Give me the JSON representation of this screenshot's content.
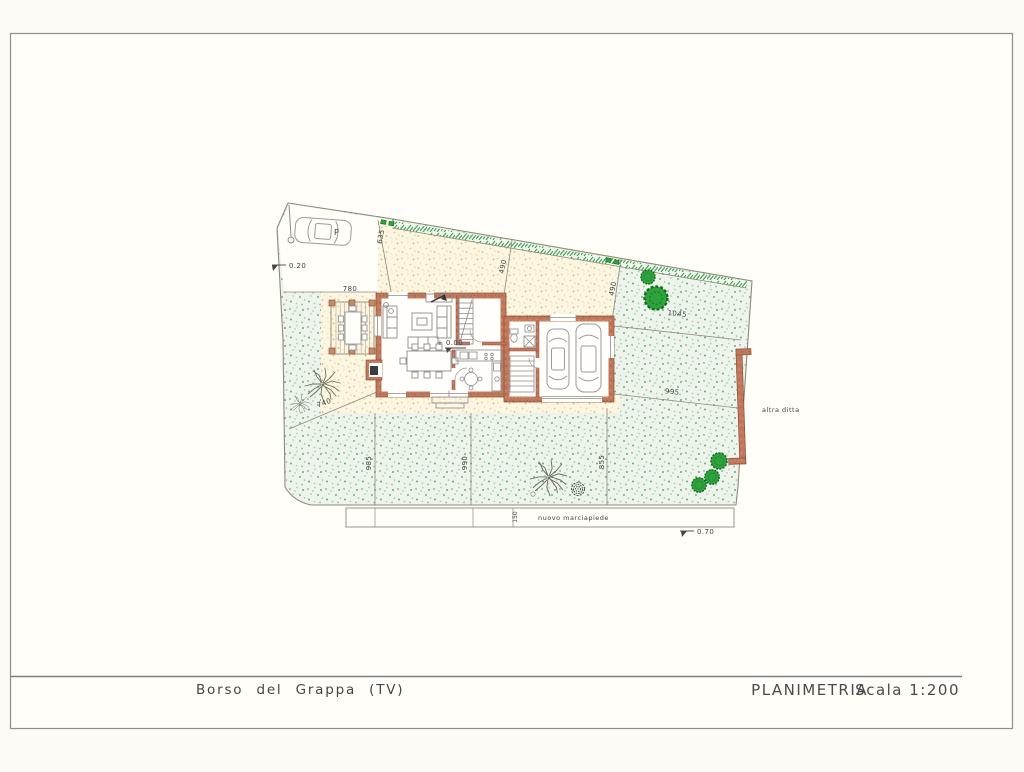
{
  "page": {
    "background": "#fcfbf6",
    "paper": "#fffef9",
    "border_color": "#8e8e8e"
  },
  "title_block": {
    "location": "Borso  del  Grappa  (TV)",
    "drawing_title": "PLANIMETRIA",
    "scale_label": "Scala  1:200"
  },
  "plan": {
    "labels": {
      "parking": "P",
      "sidewalk": "nuovo  marciapiede",
      "neighbor": "altra  ditta"
    },
    "levels": {
      "parking_level": "0.20",
      "floor_level": "+  0.00",
      "road_level": "0.70"
    },
    "dimensions": {
      "parking_side": "635",
      "north_left": "490",
      "north_right": "490",
      "east_upper": "1045",
      "east_lower": "995",
      "pergola": "780",
      "west_diag": "740",
      "south_left": "985",
      "south_center": "990",
      "south_right": "855",
      "sidewalk": "150"
    },
    "colors": {
      "wall": "#bd7156",
      "lawn_speckle": "#86bd96",
      "paved_speckle": "#e9cf7e",
      "tree_green": "#2ea33c",
      "boundary_line": "#8f897b"
    }
  }
}
